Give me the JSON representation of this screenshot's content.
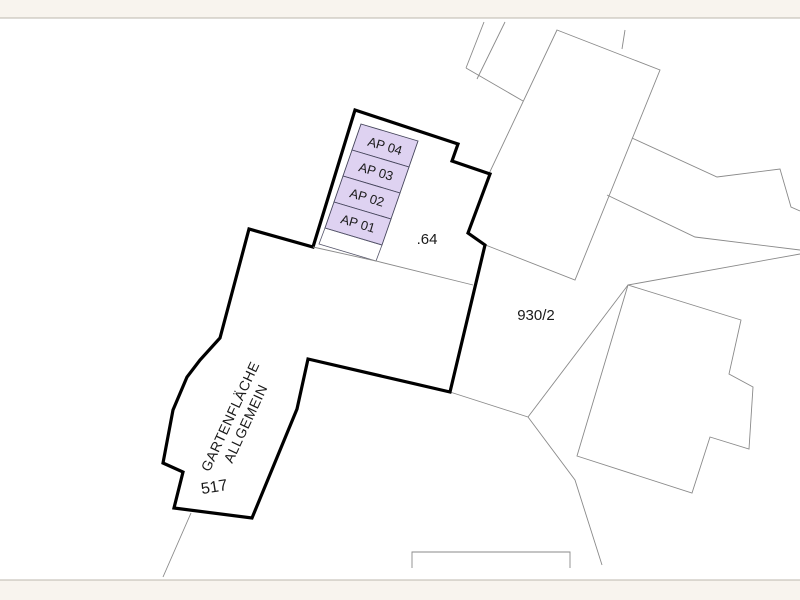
{
  "map": {
    "parking_stalls": [
      "AP 04",
      "AP 03",
      "AP 02",
      "AP 01"
    ],
    "labels": {
      "building_number": ".64",
      "neighbor_parcel": "930/2",
      "garden_parcel": "517",
      "garden_area_line1": "GARTENFLÄCHE",
      "garden_area_line2": "ALLGEMEIN"
    },
    "colors": {
      "stall_fill": "#ded2f1",
      "parcel_outline": "#000000",
      "thin_line": "#8a8a8a",
      "frame_bar": "#f8f4ee",
      "text": "#1a1a1a",
      "background": "#ffffff"
    }
  }
}
